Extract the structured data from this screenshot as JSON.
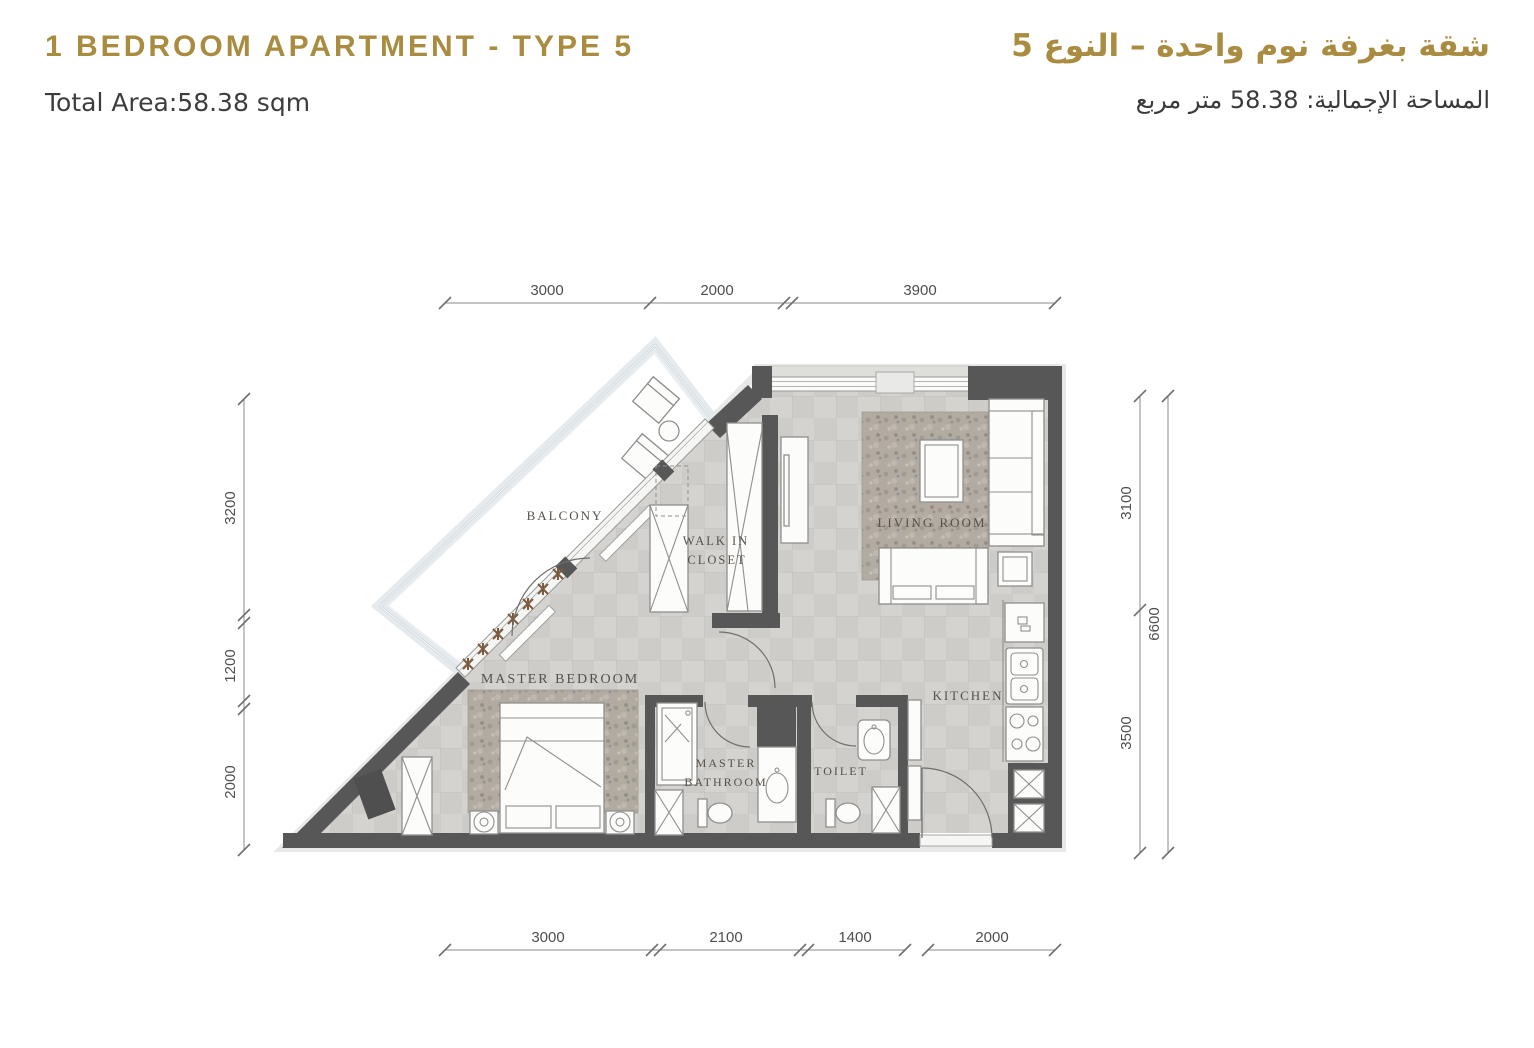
{
  "header": {
    "title_en": "1 BEDROOM APARTMENT - TYPE 5",
    "area_en": "Total Area:58.38 sqm",
    "title_ar": "شقة بغرفة نوم واحدة – النوع 5",
    "area_ar": "المساحة الإجمالية: 58.38 متر مربع"
  },
  "rooms": {
    "balcony": "BALCONY",
    "walk_in_1": "WALK IN",
    "walk_in_2": "CLOSET",
    "living_room": "LIVING ROOM",
    "master_bedroom": "MASTER BEDROOM",
    "master_bath_1": "MASTER",
    "master_bath_2": "BATHROOM",
    "toilet": "TOILET",
    "kitchen": "KITCHEN"
  },
  "dimensions": {
    "top": [
      "3000",
      "2000",
      "3900"
    ],
    "bottom": [
      "3000",
      "2100",
      "1400",
      "2000"
    ],
    "left": [
      "3200",
      "1200",
      "2000"
    ],
    "right_segments": [
      "3100",
      "3500"
    ],
    "right_total": "6600"
  },
  "colors": {
    "accent": "#a98c3f",
    "text": "#3d3d3d",
    "wall": "#575757"
  }
}
